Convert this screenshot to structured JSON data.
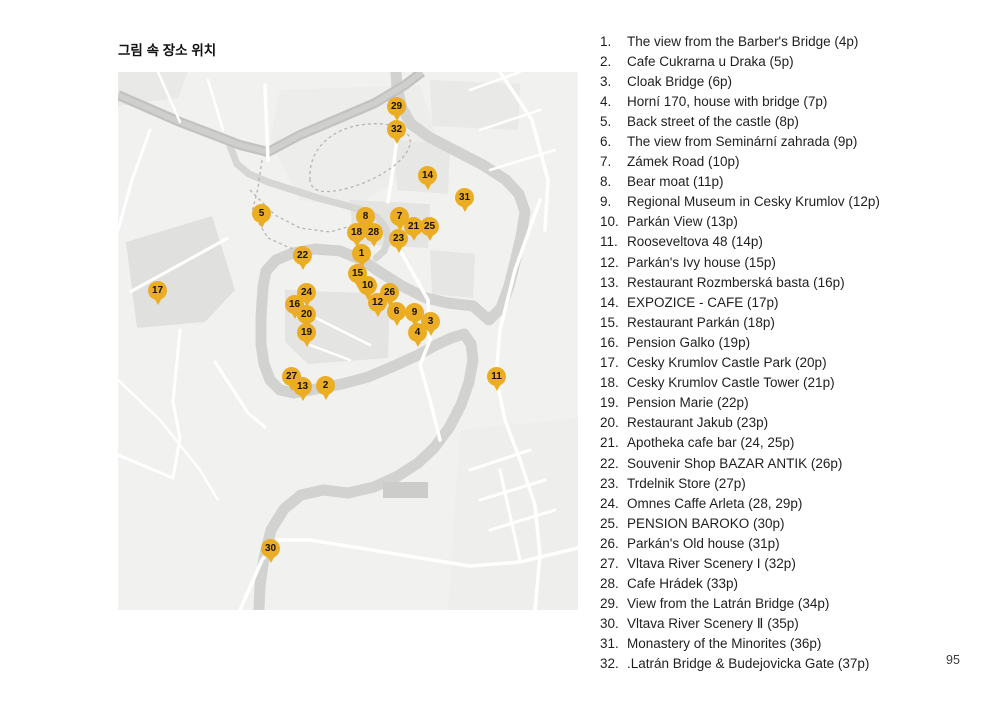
{
  "page": {
    "title": "그림 속 장소 위치",
    "page_number": "95"
  },
  "map": {
    "pin_color": "#EBAD24",
    "background_color": "#F1F1EF",
    "river_color": "#D2D2D0",
    "road_color": "#C2C2C0",
    "pins": [
      {
        "n": "1",
        "x": 244,
        "y": 182
      },
      {
        "n": "2",
        "x": 208,
        "y": 314
      },
      {
        "n": "3",
        "x": 313,
        "y": 250
      },
      {
        "n": "4",
        "x": 300,
        "y": 261
      },
      {
        "n": "5",
        "x": 144,
        "y": 142
      },
      {
        "n": "6",
        "x": 279,
        "y": 240
      },
      {
        "n": "7",
        "x": 282,
        "y": 145
      },
      {
        "n": "8",
        "x": 248,
        "y": 145
      },
      {
        "n": "9",
        "x": 297,
        "y": 241
      },
      {
        "n": "10",
        "x": 250,
        "y": 214
      },
      {
        "n": "11",
        "x": 379,
        "y": 305
      },
      {
        "n": "12",
        "x": 260,
        "y": 231
      },
      {
        "n": "13",
        "x": 185,
        "y": 315
      },
      {
        "n": "14",
        "x": 310,
        "y": 104
      },
      {
        "n": "15",
        "x": 240,
        "y": 202
      },
      {
        "n": "16",
        "x": 177,
        "y": 233
      },
      {
        "n": "17",
        "x": 40,
        "y": 219
      },
      {
        "n": "18",
        "x": 239,
        "y": 161
      },
      {
        "n": "19",
        "x": 189,
        "y": 261
      },
      {
        "n": "20",
        "x": 189,
        "y": 243
      },
      {
        "n": "21",
        "x": 296,
        "y": 155
      },
      {
        "n": "22",
        "x": 185,
        "y": 184
      },
      {
        "n": "23",
        "x": 281,
        "y": 167
      },
      {
        "n": "24",
        "x": 189,
        "y": 221
      },
      {
        "n": "25",
        "x": 312,
        "y": 155
      },
      {
        "n": "26",
        "x": 272,
        "y": 221
      },
      {
        "n": "27",
        "x": 174,
        "y": 305
      },
      {
        "n": "28",
        "x": 256,
        "y": 161
      },
      {
        "n": "29",
        "x": 279,
        "y": 35
      },
      {
        "n": "30",
        "x": 153,
        "y": 477
      },
      {
        "n": "31",
        "x": 347,
        "y": 126
      },
      {
        "n": "32",
        "x": 279,
        "y": 58
      }
    ]
  },
  "list": {
    "items": [
      {
        "num": "1.",
        "label": "The view from the Barber's Bridge (4p)"
      },
      {
        "num": "2.",
        "label": "Cafe Cukrarna u Draka (5p)"
      },
      {
        "num": "3.",
        "label": "Cloak Bridge (6p)"
      },
      {
        "num": "4.",
        "label": "Horní 170, house with bridge (7p)"
      },
      {
        "num": "5.",
        "label": "Back street of the castle (8p)"
      },
      {
        "num": "6.",
        "label": "The view from Seminární zahrada (9p)"
      },
      {
        "num": "7.",
        "label": "Zámek Road (10p)"
      },
      {
        "num": "8.",
        "label": "Bear moat (11p)"
      },
      {
        "num": "9.",
        "label": "Regional Museum in Cesky Krumlov (12p)"
      },
      {
        "num": "10.",
        "label": "Parkán View (13p)"
      },
      {
        "num": "11.",
        "label": "Rooseveltova 48 (14p)"
      },
      {
        "num": "12.",
        "label": "Parkán's Ivy house (15p)"
      },
      {
        "num": "13.",
        "label": "Restaurant Rozmberská basta (16p)"
      },
      {
        "num": "14.",
        "label": "EXPOZICE - CAFE (17p)"
      },
      {
        "num": "15.",
        "label": "Restaurant Parkán (18p)"
      },
      {
        "num": "16.",
        "label": "Pension Galko (19p)"
      },
      {
        "num": "17.",
        "label": "Cesky Krumlov Castle Park (20p)"
      },
      {
        "num": "18.",
        "label": "Cesky Krumlov Castle Tower (21p)"
      },
      {
        "num": "19.",
        "label": "Pension Marie (22p)"
      },
      {
        "num": "20.",
        "label": "Restaurant Jakub (23p)"
      },
      {
        "num": "21.",
        "label": "Apotheka cafe bar (24, 25p)"
      },
      {
        "num": "22.",
        "label": "Souvenir Shop BAZAR ANTIK (26p)"
      },
      {
        "num": "23.",
        "label": "Trdelnik Store (27p)"
      },
      {
        "num": "24.",
        "label": "Omnes Caffe Arleta (28, 29p)"
      },
      {
        "num": "25.",
        "label": "PENSION BAROKO (30p)"
      },
      {
        "num": "26.",
        "label": "Parkán's Old house (31p)"
      },
      {
        "num": "27.",
        "label": "Vltava River Scenery I (32p)"
      },
      {
        "num": "28.",
        "label": "Cafe Hrádek (33p)"
      },
      {
        "num": "29.",
        "label": "View from the Latrán Bridge (34p)"
      },
      {
        "num": "30.",
        "label": "Vltava River Scenery Ⅱ (35p)"
      },
      {
        "num": "31.",
        "label": "Monastery of the Minorites (36p)"
      },
      {
        "num": "32.",
        "label": ".Latrán Bridge & Budejovicka Gate (37p)"
      }
    ]
  }
}
